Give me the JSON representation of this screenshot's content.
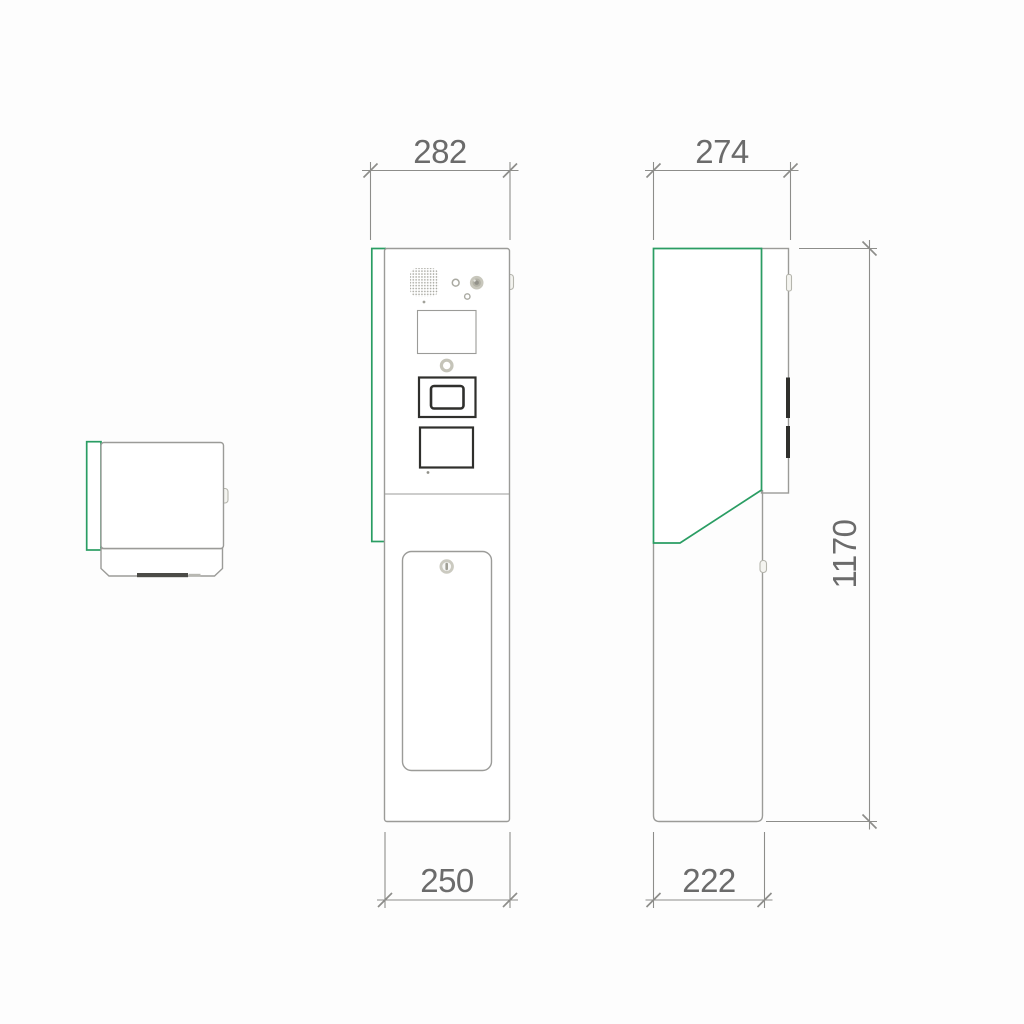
{
  "title": "Pedestal intercom column - technical drawing, three views",
  "colors": {
    "line": "#9b9b98",
    "dim": "#8d8d8a",
    "dimtext": "#6b6b6b",
    "green": "#2a9d63",
    "dark": "#2f2f2c",
    "beige": "#c8c7bc",
    "slot": "#4b4b47"
  },
  "dimensions": {
    "front_top_width": "282",
    "side_top_depth": "274",
    "front_base_width": "250",
    "side_base_depth": "222",
    "height": "1170"
  }
}
